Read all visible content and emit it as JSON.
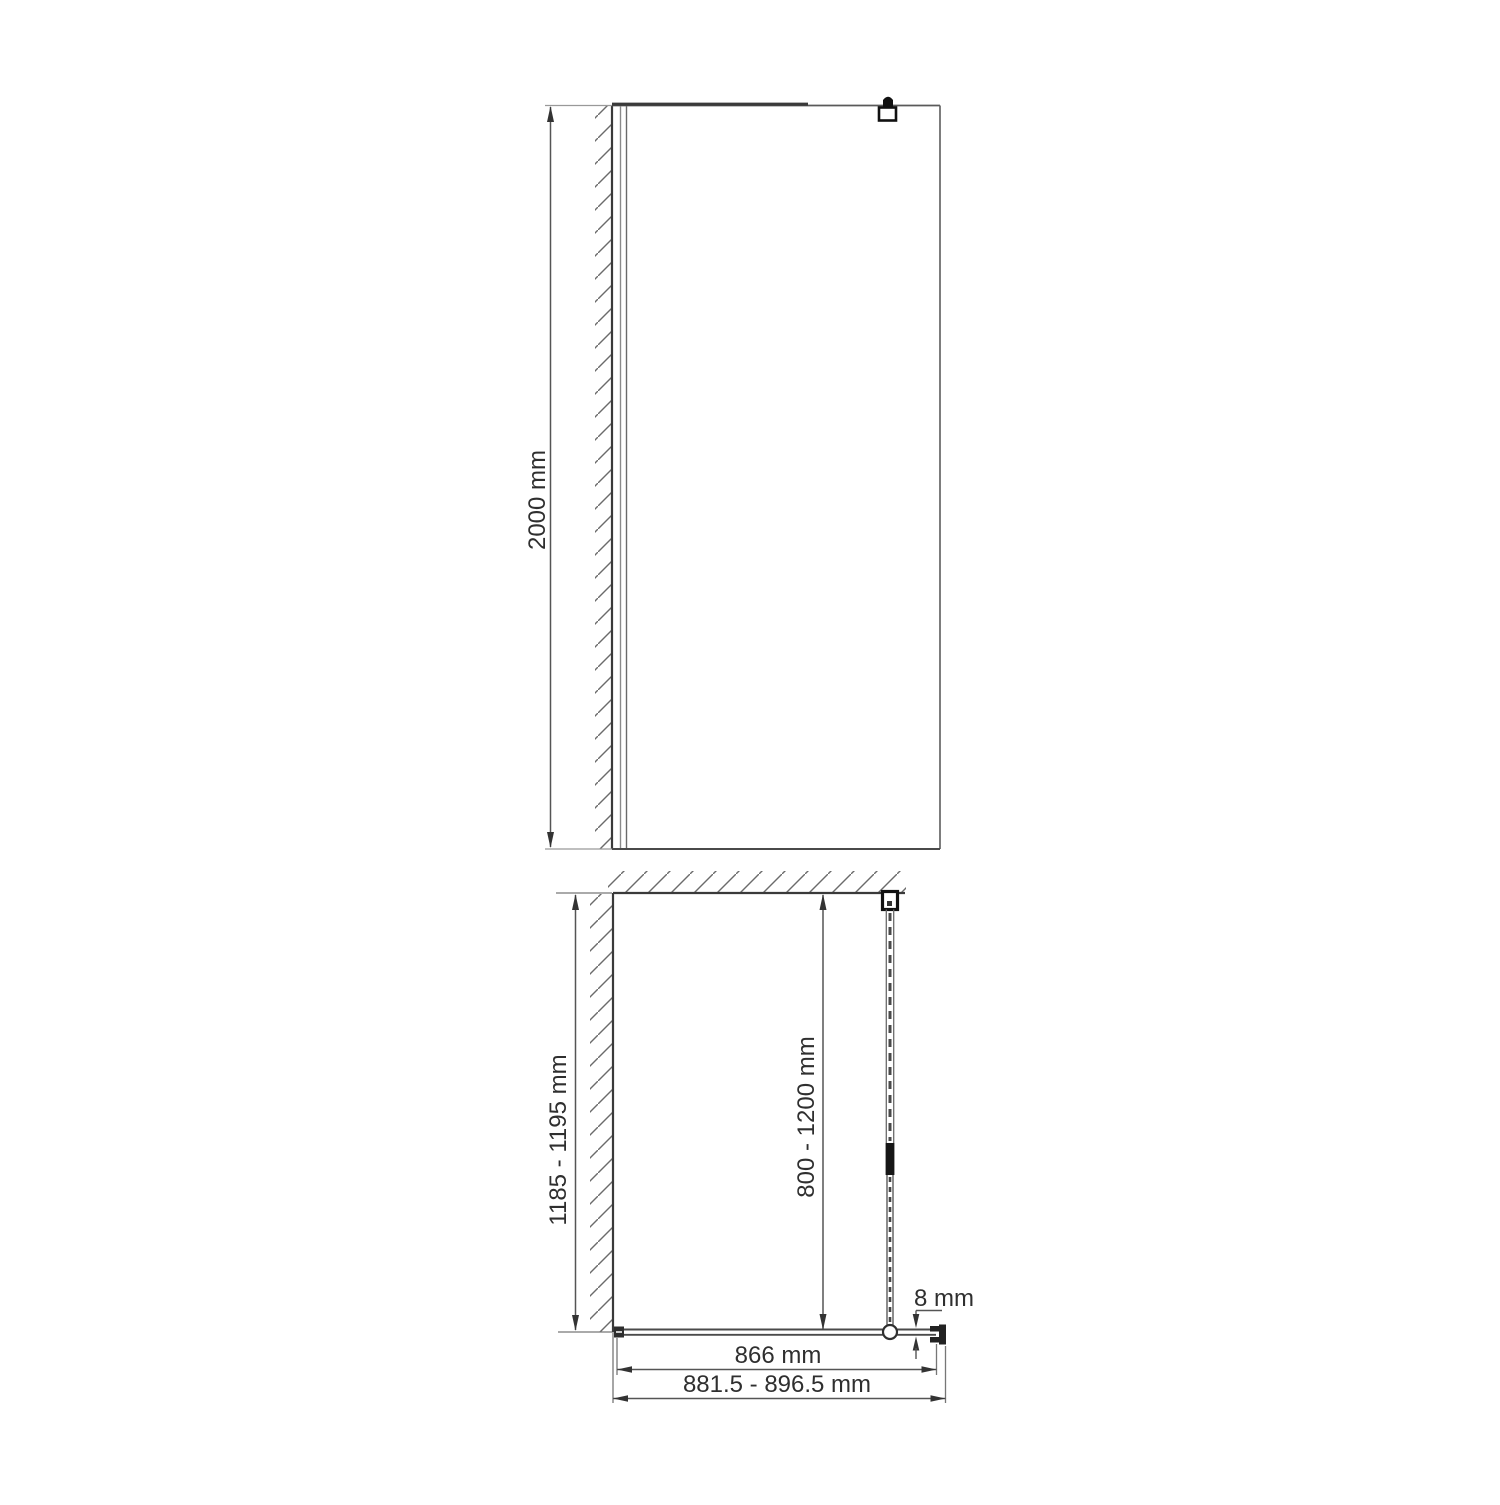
{
  "front_view": {
    "height_dimension": "2000 mm"
  },
  "plan_view": {
    "depth_dimension": "1185 - 1195 mm",
    "support_bar_dimension": "800 - 1200 mm",
    "glass_thickness_dimension": "8 mm",
    "glass_width_dimension": "866 mm",
    "overall_width_dimension": "881.5 - 896.5 mm"
  },
  "colors": {
    "outline": "#3a3a3a",
    "dimension_line": "#555555",
    "hatch": "#6b6b6b",
    "text": "#2f2f2f"
  }
}
